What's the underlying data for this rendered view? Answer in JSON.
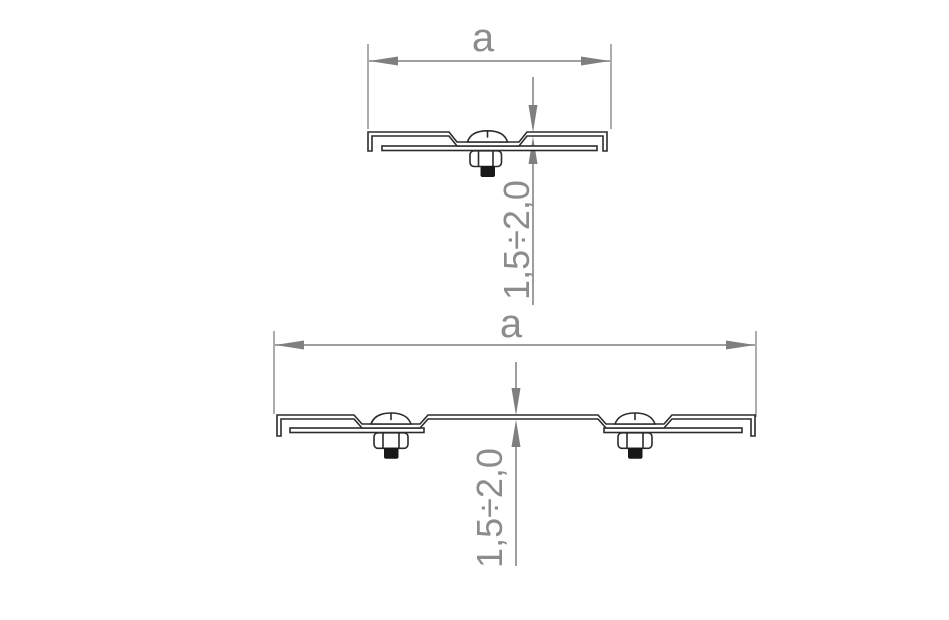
{
  "drawing": {
    "background": "#ffffff",
    "outline_color": "#2b2b2b",
    "dimension_color": "#7f7f7f",
    "label_color": "#8c8c8c",
    "views": {
      "upper": {
        "name": "short splice bracket section, one bolt",
        "width_label": "a",
        "thickness_label": "1,5÷2,0",
        "bolt_count": "1"
      },
      "lower": {
        "name": "long splice bracket section, two bolts",
        "width_label": "a",
        "thickness_label": "1,5÷2,0",
        "bolt_count": "2"
      }
    }
  }
}
